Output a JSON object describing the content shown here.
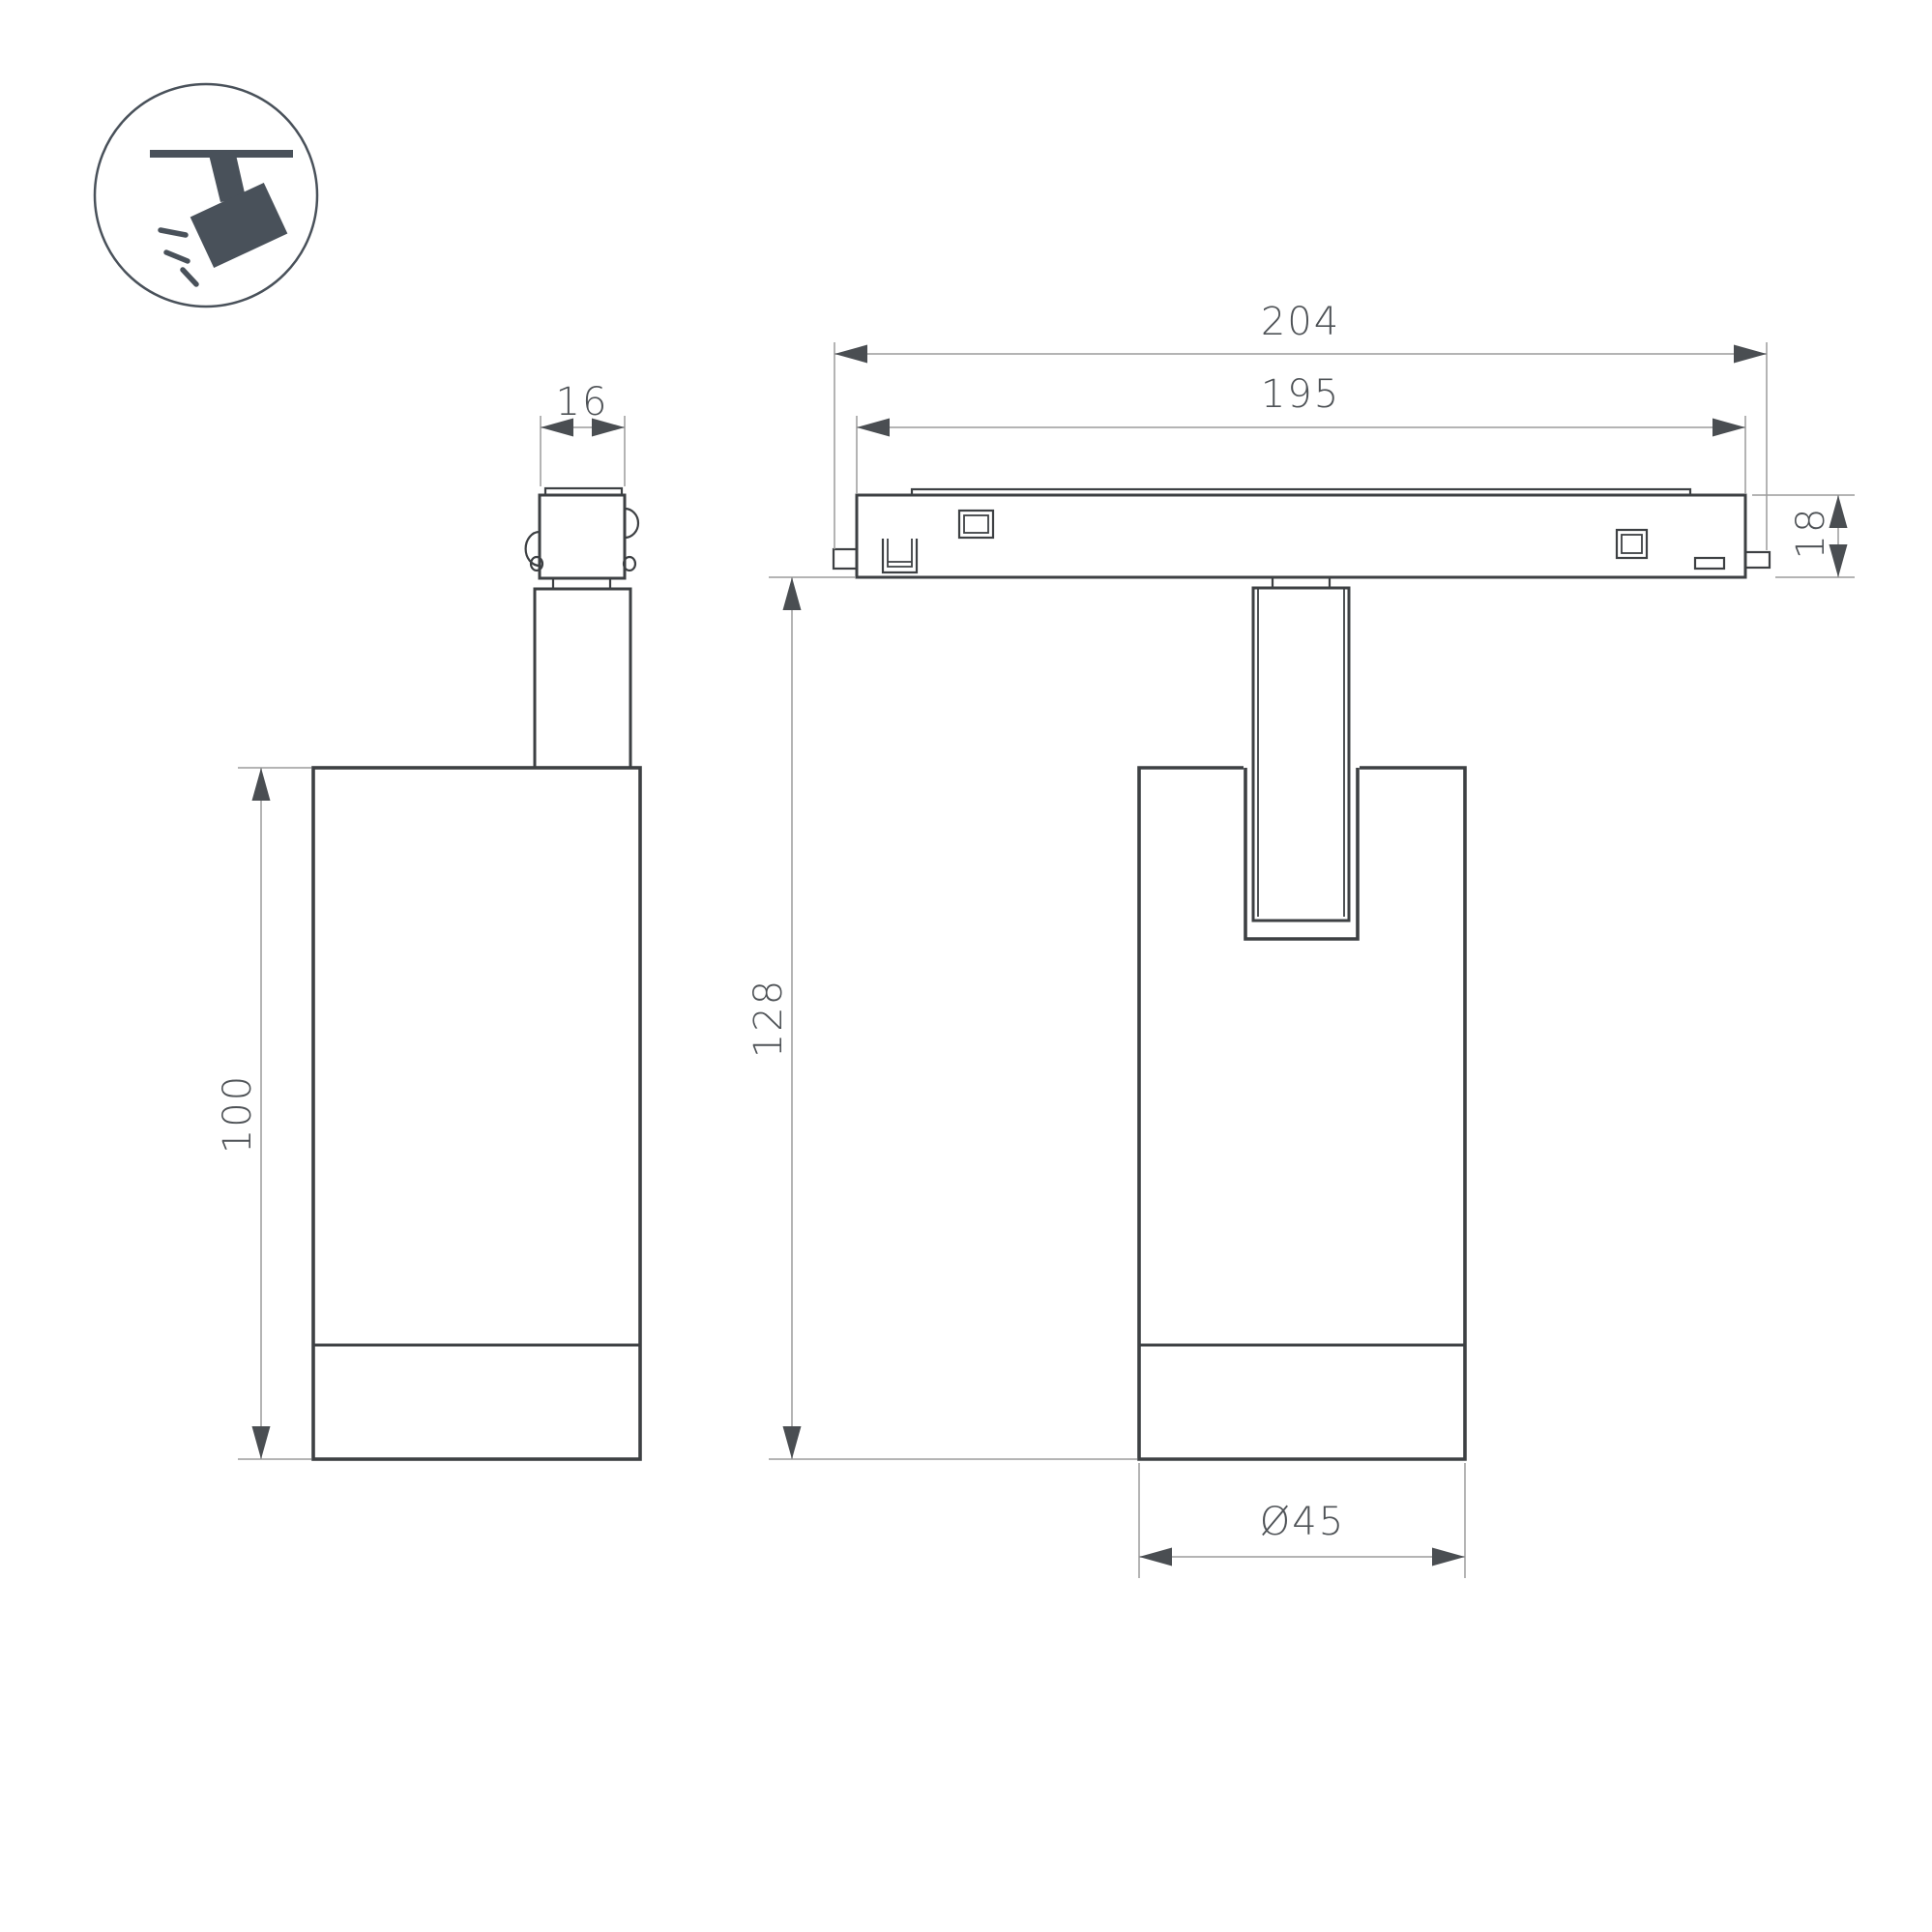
{
  "dimensions": {
    "track_overall_length": "204",
    "track_inner_length": "195",
    "adapter_width": "16",
    "track_height": "18",
    "overall_drop_height": "128",
    "lamp_body_height": "100",
    "lamp_diameter": "Ø45"
  },
  "colors": {
    "outline": "#3d4043",
    "dimension_lines": "#9b9b9b",
    "arrows_and_text": "#4e5256",
    "icon": "#49515a",
    "background": "#ffffff"
  }
}
